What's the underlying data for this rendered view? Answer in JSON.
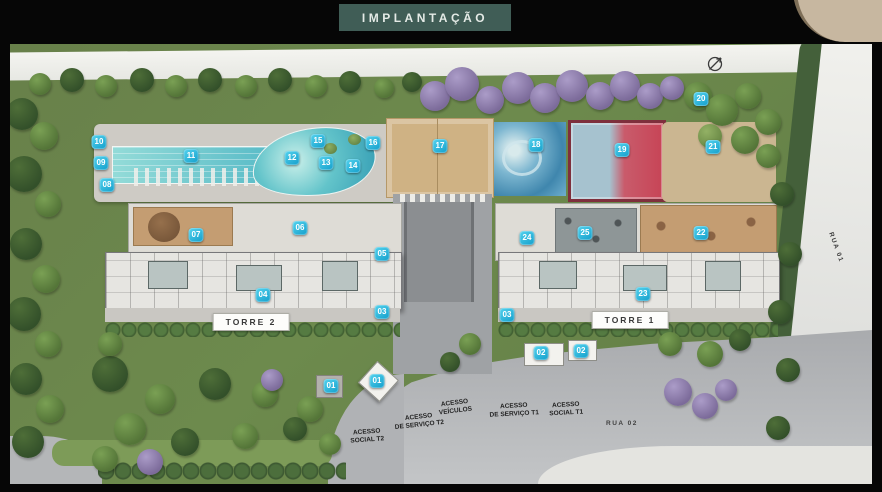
{
  "title": "IMPLANTAÇÃO",
  "towers": [
    {
      "label": "TORRE 2"
    },
    {
      "label": "TORRE 1"
    }
  ],
  "roads": [
    {
      "label": "RUA 01"
    },
    {
      "label": "RUA 02"
    }
  ],
  "access_labels": [
    {
      "lines": [
        "ACESSO",
        "VEÍCULOS"
      ],
      "x": 455,
      "y": 407,
      "rot": -7
    },
    {
      "lines": [
        "ACESSO",
        "DE SERVIÇO T2"
      ],
      "x": 419,
      "y": 421,
      "rot": -6
    },
    {
      "lines": [
        "ACESSO",
        "SOCIAL T2"
      ],
      "x": 367,
      "y": 436,
      "rot": -4
    },
    {
      "lines": [
        "ACESSO",
        "DE SERVIÇO T1"
      ],
      "x": 514,
      "y": 410,
      "rot": -3
    },
    {
      "lines": [
        "ACESSO",
        "SOCIAL T1"
      ],
      "x": 566,
      "y": 409,
      "rot": -3
    }
  ],
  "markers": [
    {
      "label": "01",
      "x": 331,
      "y": 386
    },
    {
      "label": "01",
      "x": 377,
      "y": 381
    },
    {
      "label": "02",
      "x": 541,
      "y": 353
    },
    {
      "label": "02",
      "x": 581,
      "y": 351
    },
    {
      "label": "03",
      "x": 382,
      "y": 312
    },
    {
      "label": "03",
      "x": 507,
      "y": 315
    },
    {
      "label": "04",
      "x": 263,
      "y": 295
    },
    {
      "label": "05",
      "x": 382,
      "y": 254
    },
    {
      "label": "06",
      "x": 300,
      "y": 228
    },
    {
      "label": "07",
      "x": 196,
      "y": 235
    },
    {
      "label": "08",
      "x": 107,
      "y": 185
    },
    {
      "label": "09",
      "x": 101,
      "y": 163
    },
    {
      "label": "10",
      "x": 99,
      "y": 142
    },
    {
      "label": "11",
      "x": 191,
      "y": 156
    },
    {
      "label": "12",
      "x": 292,
      "y": 158
    },
    {
      "label": "13",
      "x": 326,
      "y": 163
    },
    {
      "label": "14",
      "x": 353,
      "y": 166
    },
    {
      "label": "15",
      "x": 318,
      "y": 141
    },
    {
      "label": "16",
      "x": 373,
      "y": 143
    },
    {
      "label": "17",
      "x": 440,
      "y": 146
    },
    {
      "label": "18",
      "x": 536,
      "y": 145
    },
    {
      "label": "19",
      "x": 622,
      "y": 150
    },
    {
      "label": "20",
      "x": 701,
      "y": 99
    },
    {
      "label": "21",
      "x": 713,
      "y": 147
    },
    {
      "label": "22",
      "x": 701,
      "y": 233
    },
    {
      "label": "23",
      "x": 643,
      "y": 294
    },
    {
      "label": "24",
      "x": 527,
      "y": 238
    },
    {
      "label": "25",
      "x": 585,
      "y": 233
    }
  ],
  "icons": {
    "compass": "north-arrow"
  },
  "colors": {
    "frame": "#060606",
    "title_bg": "#405d56",
    "marker_accent": "#1fb0d8",
    "pool": "#4ab3c3",
    "court_red": "#c74456",
    "sand": "#cfb284"
  }
}
